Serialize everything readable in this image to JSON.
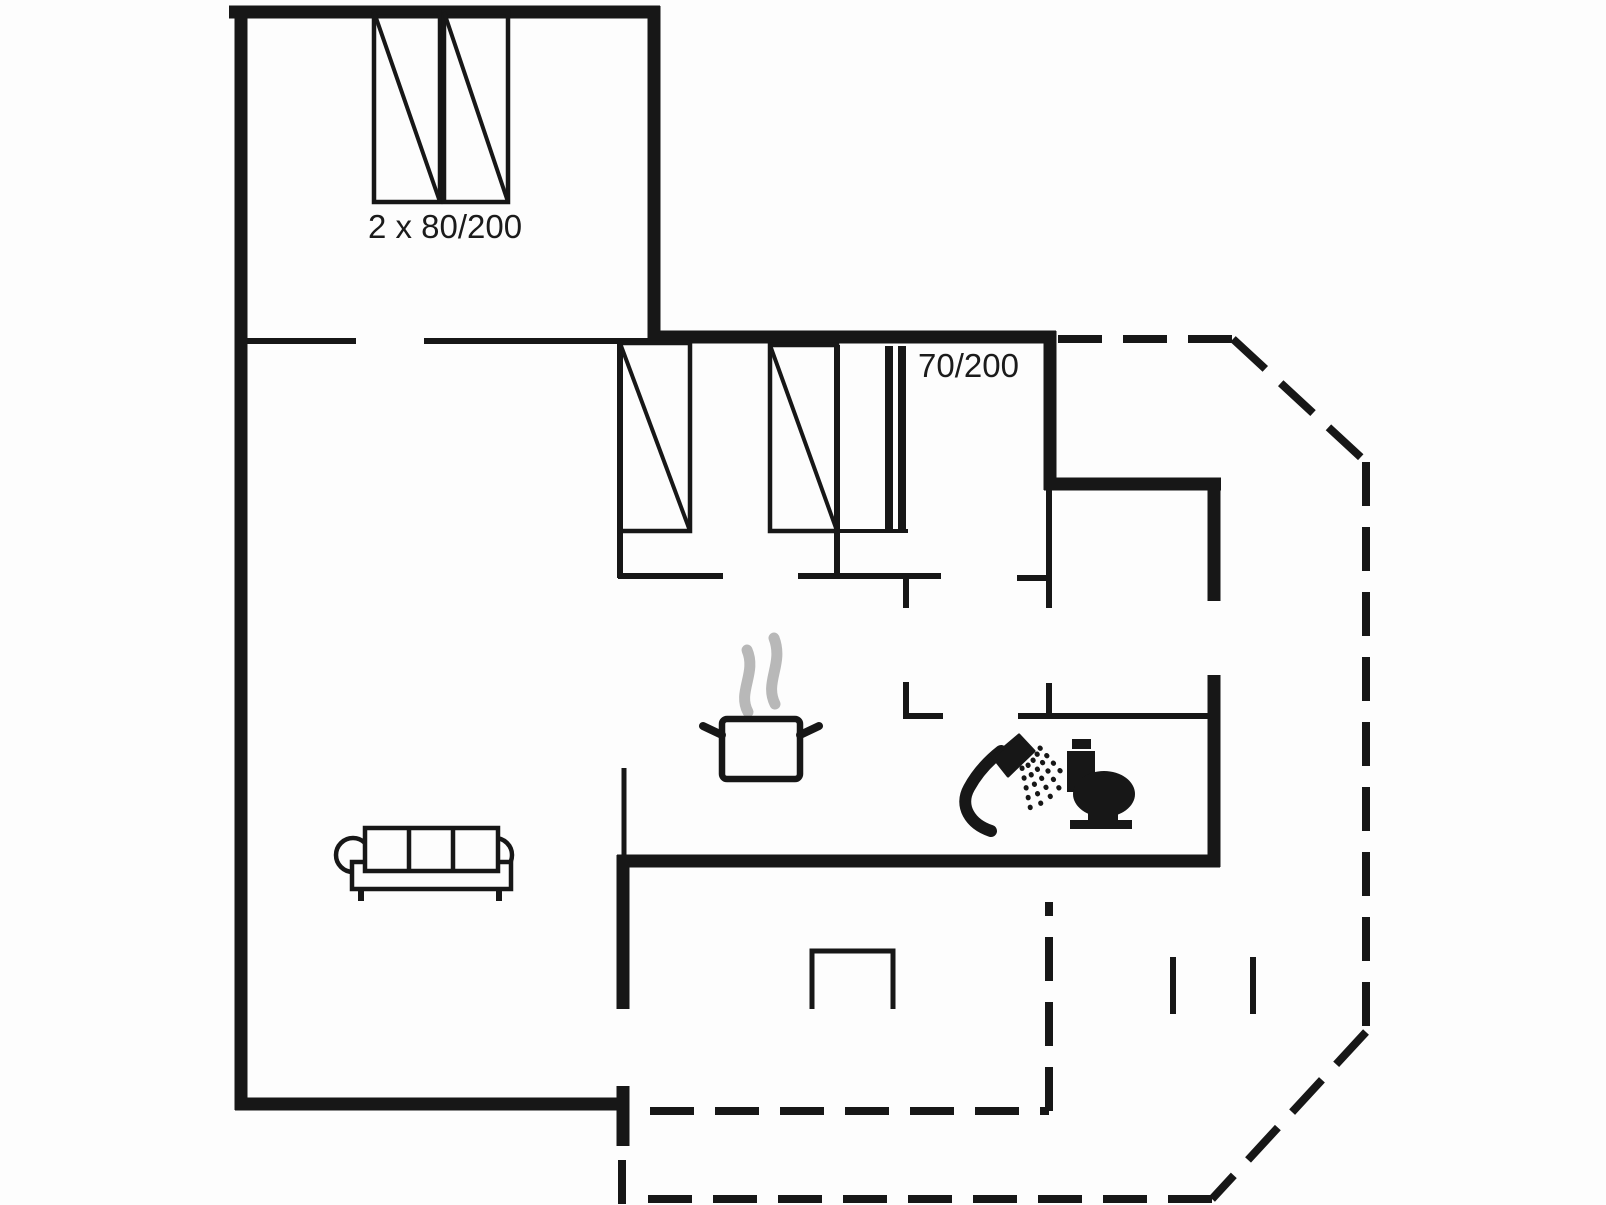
{
  "labels": {
    "double_bed_size": "2 x 80/200",
    "single_bed_size": "70/200"
  },
  "colors": {
    "background": "#fdfdfd",
    "wall": "#171717",
    "steam": "#b8b8b8"
  },
  "diagram": {
    "type": "floor-plan",
    "canvas": {
      "width": 1606,
      "height": 1205
    },
    "dash_pattern": "44 21",
    "solid_walls": [
      {
        "name": "outer-wall-top",
        "x1": 229,
        "y1": 12,
        "x2": 660,
        "y2": 12,
        "w": 13
      },
      {
        "name": "outer-wall-left",
        "x1": 241,
        "y1": 6,
        "x2": 241,
        "y2": 1110,
        "w": 13
      },
      {
        "name": "bedroom-top-right-wall",
        "x1": 654,
        "y1": 6,
        "x2": 654,
        "y2": 343,
        "w": 13
      },
      {
        "name": "outer-wall-mid-top",
        "x1": 648,
        "y1": 337,
        "x2": 1056,
        "y2": 337,
        "w": 13
      },
      {
        "name": "hall-wall-upper",
        "x1": 1050,
        "y1": 331,
        "x2": 1050,
        "y2": 490,
        "w": 13
      },
      {
        "name": "entry-room-top-wall",
        "x1": 1044,
        "y1": 484,
        "x2": 1221,
        "y2": 484,
        "w": 13
      },
      {
        "name": "outer-wall-right-upper",
        "x1": 1214,
        "y1": 484,
        "x2": 1214,
        "y2": 601,
        "w": 13
      },
      {
        "name": "outer-wall-right-lower",
        "x1": 1214,
        "y1": 675,
        "x2": 1214,
        "y2": 867,
        "w": 13
      },
      {
        "name": "bath-bottom-wall",
        "x1": 617,
        "y1": 861,
        "x2": 1220,
        "y2": 861,
        "w": 13
      },
      {
        "name": "kitchen-wall-left-thick",
        "x1": 623,
        "y1": 855,
        "x2": 623,
        "y2": 1009,
        "w": 13
      },
      {
        "name": "outer-wall-bottom",
        "x1": 235,
        "y1": 1104,
        "x2": 629,
        "y2": 1104,
        "w": 13
      },
      {
        "name": "terrace-door-post",
        "x1": 623,
        "y1": 1086,
        "x2": 623,
        "y2": 1146,
        "w": 13
      },
      {
        "name": "bedroom-wall-left",
        "x1": 620,
        "y1": 343,
        "x2": 620,
        "y2": 578,
        "w": 6
      },
      {
        "name": "bedroom-divider-wall",
        "x1": 837,
        "y1": 345,
        "x2": 837,
        "y2": 578,
        "w": 6
      },
      {
        "name": "living-divider-seg1",
        "x1": 247,
        "y1": 341,
        "x2": 356,
        "y2": 341,
        "w": 6
      },
      {
        "name": "living-divider-seg2",
        "x1": 424,
        "y1": 341,
        "x2": 650,
        "y2": 341,
        "w": 6
      },
      {
        "name": "bedroom-bottom-wall-seg1",
        "x1": 618,
        "y1": 576,
        "x2": 723,
        "y2": 576,
        "w": 6
      },
      {
        "name": "bedroom-bottom-wall-seg2",
        "x1": 798,
        "y1": 576,
        "x2": 941,
        "y2": 576,
        "w": 6
      },
      {
        "name": "hall-door-tick",
        "x1": 906,
        "y1": 576,
        "x2": 906,
        "y2": 608,
        "w": 6
      },
      {
        "name": "bath-wall-left",
        "x1": 906,
        "y1": 682,
        "x2": 906,
        "y2": 719,
        "w": 6
      },
      {
        "name": "bath-top-wall-seg1",
        "x1": 903,
        "y1": 716,
        "x2": 943,
        "y2": 716,
        "w": 6
      },
      {
        "name": "bath-top-wall-seg2",
        "x1": 1018,
        "y1": 716,
        "x2": 1216,
        "y2": 716,
        "w": 6
      },
      {
        "name": "hall-wall-thin",
        "x1": 1049,
        "y1": 490,
        "x2": 1049,
        "y2": 608,
        "w": 6
      },
      {
        "name": "hall-wall-stub",
        "x1": 1017,
        "y1": 578,
        "x2": 1049,
        "y2": 578,
        "w": 6
      },
      {
        "name": "bath-door-tick",
        "x1": 1049,
        "y1": 683,
        "x2": 1049,
        "y2": 719,
        "w": 6
      },
      {
        "name": "kitchen-wall-thin",
        "x1": 624,
        "y1": 768,
        "x2": 624,
        "y2": 858,
        "w": 5
      },
      {
        "name": "wardrobe-line-1",
        "x1": 889,
        "y1": 346,
        "x2": 889,
        "y2": 529,
        "w": 8
      },
      {
        "name": "wardrobe-line-2",
        "x1": 902,
        "y1": 346,
        "x2": 902,
        "y2": 529,
        "w": 8
      },
      {
        "name": "bed-extension-line",
        "x1": 837,
        "y1": 531,
        "x2": 908,
        "y2": 531,
        "w": 4
      },
      {
        "name": "terrace-mark-1",
        "x1": 1173,
        "y1": 957,
        "x2": 1173,
        "y2": 1014,
        "w": 6
      },
      {
        "name": "terrace-mark-2",
        "x1": 1253,
        "y1": 957,
        "x2": 1253,
        "y2": 1014,
        "w": 6
      }
    ],
    "dashed_walls": [
      {
        "name": "terrace-outline-top",
        "x1": 1058,
        "y1": 339,
        "x2": 1233,
        "y2": 339,
        "w": 8
      },
      {
        "name": "terrace-outline-diag-top",
        "x1": 1233,
        "y1": 339,
        "x2": 1366,
        "y2": 462,
        "w": 8
      },
      {
        "name": "terrace-outline-right",
        "x1": 1366,
        "y1": 462,
        "x2": 1366,
        "y2": 1032,
        "w": 8
      },
      {
        "name": "terrace-outline-diag-bottom",
        "x1": 1366,
        "y1": 1032,
        "x2": 1212,
        "y2": 1199,
        "w": 8
      },
      {
        "name": "terrace-outline-bottom",
        "x1": 1212,
        "y1": 1199,
        "x2": 648,
        "y2": 1199,
        "w": 8
      },
      {
        "name": "terrace-outline-left-stub",
        "x1": 622,
        "y1": 1160,
        "x2": 622,
        "y2": 1205,
        "w": 8
      },
      {
        "name": "patio-outline-bottom",
        "x1": 650,
        "y1": 1111,
        "x2": 1049,
        "y2": 1111,
        "w": 8
      },
      {
        "name": "patio-outline-right",
        "x1": 1049,
        "y1": 1111,
        "x2": 1049,
        "y2": 902,
        "w": 8
      }
    ],
    "beds": [
      {
        "name": "double-bed-left-icon",
        "x": 374,
        "y": 12,
        "w": 66,
        "h": 190
      },
      {
        "name": "double-bed-right-icon",
        "x": 444,
        "y": 12,
        "w": 64,
        "h": 190
      },
      {
        "name": "single-bed-1-icon",
        "x": 620,
        "y": 343,
        "w": 70,
        "h": 188
      },
      {
        "name": "single-bed-2-icon",
        "x": 770,
        "y": 345,
        "w": 67,
        "h": 186
      }
    ],
    "furniture": [
      {
        "name": "sofa-icon",
        "prims": [
          {
            "t": "circle",
            "a": {
              "cx": 353,
              "cy": 855,
              "r": 17,
              "fill": "#fdfdfd",
              "stroke": "#171717",
              "stroke-width": 4.5
            }
          },
          {
            "t": "circle",
            "a": {
              "cx": 495,
              "cy": 855,
              "r": 17,
              "fill": "#fdfdfd",
              "stroke": "#171717",
              "stroke-width": 4.5
            }
          },
          {
            "t": "rect",
            "a": {
              "x": 352,
              "y": 862,
              "width": 159,
              "height": 27,
              "fill": "#fdfdfd",
              "stroke": "#171717",
              "stroke-width": 4.5
            }
          },
          {
            "t": "rect",
            "a": {
              "x": 365,
              "y": 828,
              "width": 133,
              "height": 43,
              "fill": "#fdfdfd",
              "stroke": "#171717",
              "stroke-width": 4.5
            }
          },
          {
            "t": "line",
            "a": {
              "x1": 409,
              "y1": 828,
              "x2": 409,
              "y2": 871,
              "stroke": "#171717",
              "stroke-width": 4.5
            }
          },
          {
            "t": "line",
            "a": {
              "x1": 453,
              "y1": 828,
              "x2": 453,
              "y2": 871,
              "stroke": "#171717",
              "stroke-width": 4.5
            }
          },
          {
            "t": "line",
            "a": {
              "x1": 361,
              "y1": 889,
              "x2": 361,
              "y2": 901,
              "stroke": "#171717",
              "stroke-width": 6
            }
          },
          {
            "t": "line",
            "a": {
              "x1": 499,
              "y1": 889,
              "x2": 499,
              "y2": 901,
              "stroke": "#171717",
              "stroke-width": 6
            }
          }
        ]
      },
      {
        "name": "steam-icon",
        "prims": [
          {
            "t": "path",
            "a": {
              "d": "M 748,712 C 737,692 757,673 747,650",
              "fill": "none",
              "stroke": "#b8b8b8",
              "stroke-width": 11,
              "stroke-linecap": "round"
            }
          },
          {
            "t": "path",
            "a": {
              "d": "M 775,704 C 764,682 784,664 774,638",
              "fill": "none",
              "stroke": "#b8b8b8",
              "stroke-width": 11,
              "stroke-linecap": "round"
            }
          }
        ]
      },
      {
        "name": "cooking-pot-icon",
        "prims": [
          {
            "t": "rect",
            "a": {
              "x": 722,
              "y": 719,
              "width": 78,
              "height": 60,
              "rx": 5,
              "fill": "#fdfdfd",
              "stroke": "#171717",
              "stroke-width": 6.5
            }
          },
          {
            "t": "line",
            "a": {
              "x1": 722,
              "y1": 735,
              "x2": 703,
              "y2": 726,
              "stroke": "#171717",
              "stroke-width": 8,
              "stroke-linecap": "round"
            }
          },
          {
            "t": "line",
            "a": {
              "x1": 800,
              "y1": 735,
              "x2": 819,
              "y2": 726,
              "stroke": "#171717",
              "stroke-width": 8,
              "stroke-linecap": "round"
            }
          }
        ]
      },
      {
        "name": "shower-icon",
        "prims": [
          {
            "t": "path",
            "a": {
              "d": "M 991,831 C 970,824 959,806 969,788 C 976,775 987,762 1001,751",
              "fill": "none",
              "stroke": "#171717",
              "stroke-width": 12,
              "stroke-linecap": "round"
            }
          },
          {
            "t": "path",
            "a": {
              "d": "M 993,757 L 1019,735 L 1034,751 L 1008,776 Z",
              "fill": "#171717",
              "stroke": "#171717",
              "stroke-width": 3,
              "stroke-linejoin": "round"
            }
          },
          {
            "t": "line",
            "a": {
              "x1": 1022,
              "y1": 768,
              "x2": 1032,
              "y2": 816,
              "stroke": "#171717",
              "stroke-width": 5,
              "stroke-linecap": "round",
              "stroke-dasharray": "0.5 9.5"
            }
          },
          {
            "t": "line",
            "a": {
              "x1": 1028,
              "y1": 765,
              "x2": 1043,
              "y2": 810,
              "stroke": "#171717",
              "stroke-width": 5,
              "stroke-linecap": "round",
              "stroke-dasharray": "0.5 9.5"
            }
          },
          {
            "t": "line",
            "a": {
              "x1": 1033,
              "y1": 760,
              "x2": 1052,
              "y2": 800,
              "stroke": "#171717",
              "stroke-width": 5,
              "stroke-linecap": "round",
              "stroke-dasharray": "0.5 9.5"
            }
          },
          {
            "t": "line",
            "a": {
              "x1": 1037,
              "y1": 754,
              "x2": 1059,
              "y2": 788,
              "stroke": "#171717",
              "stroke-width": 5,
              "stroke-linecap": "round",
              "stroke-dasharray": "0.5 9.5"
            }
          },
          {
            "t": "line",
            "a": {
              "x1": 1040,
              "y1": 748,
              "x2": 1063,
              "y2": 774,
              "stroke": "#171717",
              "stroke-width": 5,
              "stroke-linecap": "round",
              "stroke-dasharray": "0.5 9.5"
            }
          }
        ]
      },
      {
        "name": "toilet-icon",
        "prims": [
          {
            "t": "rect",
            "a": {
              "x": 1072,
              "y": 739,
              "width": 19,
              "height": 10,
              "fill": "#171717"
            }
          },
          {
            "t": "rect",
            "a": {
              "x": 1067,
              "y": 751,
              "width": 28,
              "height": 41,
              "fill": "#171717"
            }
          },
          {
            "t": "ellipse",
            "a": {
              "cx": 1104,
              "cy": 794,
              "rx": 31,
              "ry": 23,
              "fill": "#171717"
            }
          },
          {
            "t": "rect",
            "a": {
              "x": 1088,
              "y": 810,
              "width": 30,
              "height": 12,
              "fill": "#171717"
            }
          },
          {
            "t": "rect",
            "a": {
              "x": 1070,
              "y": 820,
              "width": 62,
              "height": 9,
              "fill": "#171717"
            }
          }
        ]
      },
      {
        "name": "table-icon",
        "prims": [
          {
            "t": "path",
            "a": {
              "d": "M 812,1009 L 812,951 L 893,951 L 893,1009",
              "fill": "none",
              "stroke": "#171717",
              "stroke-width": 5
            }
          }
        ]
      }
    ]
  }
}
